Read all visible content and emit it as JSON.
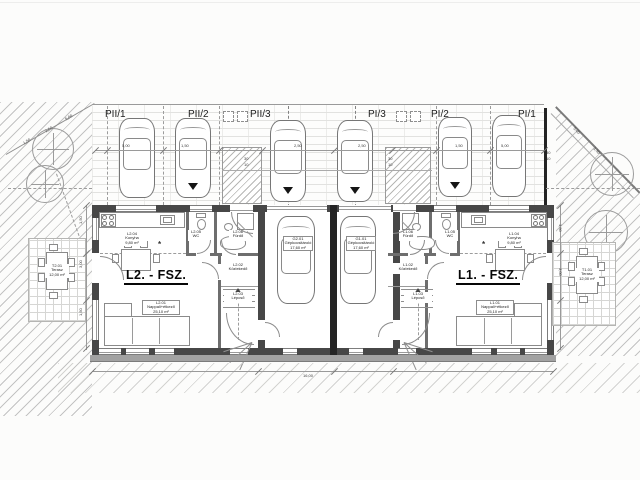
{
  "plan": {
    "parking": {
      "labels": [
        "PII/1",
        "PII/2",
        "PII/3",
        "PI/3",
        "PI/2",
        "PI/1"
      ]
    },
    "units": {
      "l2": {
        "label": "L2. - FSZ.",
        "rooms": {
          "living": {
            "code": "L2.01",
            "name": "Nappali+étkező",
            "area": "25,10 m²"
          },
          "hall": {
            "code": "L2.02",
            "name": "Közlekedő",
            "area": "5,20 m²"
          },
          "stairs": {
            "code": "L2.03",
            "name": "Lépcső",
            "area": "4,80 m²"
          },
          "kitchen": {
            "code": "L2.04",
            "name": "Konyha",
            "area": "9,80 m²"
          },
          "wc": {
            "code": "L2.05",
            "name": "WC",
            "area": "1,80 m²"
          },
          "bath": {
            "code": "L2.06",
            "name": "Fürdő",
            "area": "4,60 m²"
          }
        }
      },
      "l1": {
        "label": "L1. - FSZ.",
        "rooms": {
          "living": {
            "code": "L1.01",
            "name": "Nappali+étkező",
            "area": "25,10 m²"
          },
          "hall": {
            "code": "L1.02",
            "name": "Közlekedő",
            "area": "5,20 m²"
          },
          "stairs": {
            "code": "L1.03",
            "name": "Lépcső",
            "area": "4,80 m²"
          },
          "kitchen": {
            "code": "L1.04",
            "name": "Konyha",
            "area": "9,80 m²"
          },
          "wc": {
            "code": "L1.05",
            "name": "WC",
            "area": "1,80 m²"
          },
          "bath": {
            "code": "L1.06",
            "name": "Fürdő",
            "area": "4,60 m²"
          }
        }
      }
    },
    "garages": {
      "g2": {
        "code": "G2.01",
        "name": "Gépkocsitároló",
        "area": "17,60 m²"
      },
      "g1": {
        "code": "G1.01",
        "name": "Gépkocsitároló",
        "area": "17,60 m²"
      }
    },
    "terraces": {
      "t2": {
        "code": "T2.01",
        "name": "Terasz",
        "area": "12,00 m²"
      },
      "t1": {
        "code": "T1.01",
        "name": "Terasz",
        "area": "12,00 m²"
      }
    },
    "symbols": {
      "lamp": "*"
    },
    "dims": {
      "a": "5,00",
      "b": "1,50",
      "c": "2,50",
      "d": "3,00",
      "e": "30",
      "f": "10",
      "g": "16,00"
    }
  }
}
